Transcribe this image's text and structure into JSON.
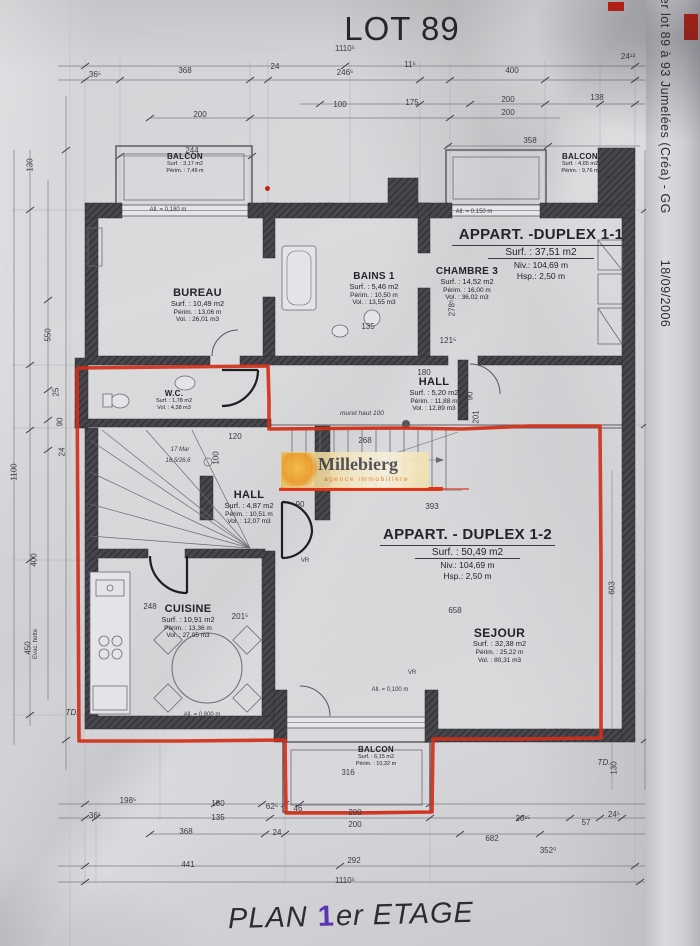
{
  "title": "LOT 89",
  "footer": {
    "pre": "PLAN",
    "num": "1",
    "post": "er ETAGE"
  },
  "side_note": {
    "line": "mer lot 89 à 93 Jumelées (Créa) - GG",
    "date": "18/09/2006"
  },
  "watermark": {
    "name": "Millebierg",
    "tagline": "agence immobilière"
  },
  "colors": {
    "red_marker": "#d32f18",
    "purple_pen": "#5a35b0",
    "watermark_orange": "#e8791e",
    "watermark_bar": "#e03418",
    "wall_dark": "#46464c"
  },
  "rooms": {
    "balcon_tl": {
      "name": "BALCON",
      "l1": "Surf. : 3,17 m2",
      "l2": "Périm. : 7,49 m"
    },
    "balcon_tr": {
      "name": "BALCON",
      "l1": "Surf. : 4,65 m2",
      "l2": "Périm. : 9,76 m"
    },
    "appart11": {
      "name": "APPART. -DUPLEX 1-1",
      "l1": "Surf. : 37,51 m2",
      "l2": "Niv.: 104,69 m",
      "l3": "Hsp.: 2,50 m"
    },
    "bureau": {
      "name": "BUREAU",
      "l1": "Surf. : 10,49 m2",
      "l2": "Périm. : 13,06 m",
      "l3": "Vol. : 26,01 m3"
    },
    "bains1": {
      "name": "BAINS 1",
      "l1": "Surf. : 5,46 m2",
      "l2": "Périm. : 10,50 m",
      "l3": "Vol. : 13,55 m3"
    },
    "chambre3": {
      "name": "CHAMBRE 3",
      "l1": "Surf. : 14,52 m2",
      "l2": "Périm. : 16,00 m",
      "l3": "Vol. : 36,02 m3"
    },
    "hall_upper": {
      "name": "HALL",
      "l1": "Surf. : 5,20 m2",
      "l2": "Périm. : 11,88 m",
      "l3": "Vol. : 12,89 m3"
    },
    "wc": {
      "name": "W.C.",
      "l1": "Surf. : 1,78 m2",
      "l2": "Vol. : 4,38 m3"
    },
    "hall_lower": {
      "name": "HALL",
      "l1": "Surf. : 4,87 m2",
      "l2": "Périm. : 10,51 m",
      "l3": "Vol. : 12,07 m3"
    },
    "cuisine": {
      "name": "CUISINE",
      "l1": "Surf. : 10,91 m2",
      "l2": "Périm. : 13,36 m",
      "l3": "Vol. : 27,05 m3"
    },
    "appart12": {
      "name": "APPART. - DUPLEX 1-2",
      "l1": "Surf.  : 50,49 m2",
      "l2": "Niv.: 104,69 m",
      "l3": "Hsp.: 2,50 m"
    },
    "sejour": {
      "name": "SEJOUR",
      "l1": "Surf.  : 32,38 m2",
      "l2": "Périm. : 25,22 m",
      "l3": "Vol.  : 80,31 m3"
    },
    "balcon_b": {
      "name": "BALCON",
      "l1": "Surf. : 6,15 m2",
      "l2": "Périm. : 10,32 m"
    }
  },
  "annotations": {
    "muret": "muret haut 100",
    "stair_a": "17 Mar",
    "stair_b": "16,5/26,6",
    "td": "TD.",
    "all_180": "All. = 0,180 m",
    "all_800": "All. = 0,800 m",
    "all_150": "All. = 0,150 m",
    "all_900": "All. = 0,900 m",
    "all_100": "All. = 0,100 m",
    "evac": "Evac. hotte",
    "vr": "VR"
  },
  "dims": {
    "top": [
      "1110⁵",
      "36⁵",
      "368",
      "24",
      "246⁵",
      "11⁵",
      "400",
      "24¹²",
      "100",
      "175",
      "200",
      "138",
      "200",
      "200",
      "244",
      "358"
    ],
    "bottom": [
      "198⁵",
      "180",
      "62⁵",
      "46",
      "200",
      "36⁵",
      "135",
      "24",
      "200",
      "20¹⁵",
      "57",
      "24⁵",
      "368",
      "682",
      "352⁰",
      "441",
      "292",
      "1110⁵"
    ],
    "left": [
      "130",
      "550",
      "25",
      "90",
      "24",
      "1100",
      "400",
      "450"
    ],
    "right": [
      "278⁵",
      "121⁵",
      "603",
      "130",
      "90",
      "201"
    ],
    "inner": [
      "135",
      "180",
      "120",
      "100",
      "268",
      "393",
      "658",
      "248",
      "201⁵",
      "316",
      "90"
    ]
  }
}
